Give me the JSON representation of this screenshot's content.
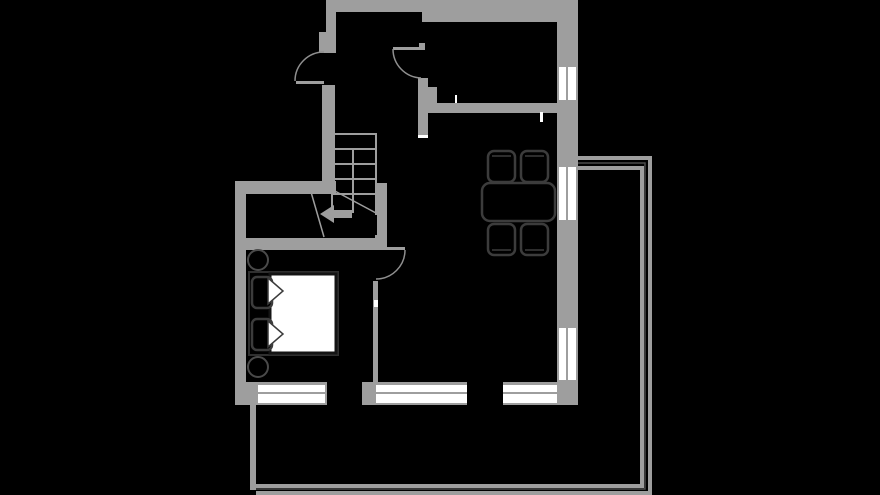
{
  "canvas": {
    "width": 880,
    "height": 495,
    "background": "#000000"
  },
  "palette": {
    "bg": "#000000",
    "wall": "#9e9e9e",
    "window": "#ffffff",
    "tick": "#ffffff",
    "arc": "#8f8f8f",
    "dark": "#4a4a4a",
    "furn": "#3c3c3c",
    "bedframe": "#2f2f2f",
    "mattress": "#ffffff",
    "mattressStroke": "#141414",
    "black": "#000000"
  },
  "floorplan": {
    "layers": [
      {
        "name": "walls",
        "items": [
          {
            "name": "wall-top-band-left",
            "kind": "rect",
            "x": 326,
            "y": 0,
            "w": 104,
            "h": 12,
            "fill": "wall"
          },
          {
            "name": "wall-top-band-right",
            "kind": "rect",
            "x": 422,
            "y": 0,
            "w": 156,
            "h": 22,
            "fill": "wall"
          },
          {
            "name": "wall-entry-upper",
            "kind": "rect",
            "x": 326,
            "y": 0,
            "w": 10,
            "h": 53,
            "fill": "wall"
          },
          {
            "name": "wall-entry-jog",
            "kind": "rect",
            "x": 319,
            "y": 32,
            "w": 8,
            "h": 21,
            "fill": "wall"
          },
          {
            "name": "wall-entry-lower",
            "kind": "rect",
            "x": 322,
            "y": 85,
            "w": 13,
            "h": 96,
            "fill": "wall"
          },
          {
            "name": "wall-hall-top",
            "kind": "rect",
            "x": 235,
            "y": 181,
            "w": 101,
            "h": 13,
            "fill": "wall"
          },
          {
            "name": "wall-left-outer",
            "kind": "rect",
            "x": 235,
            "y": 181,
            "w": 11,
            "h": 224,
            "fill": "wall"
          },
          {
            "name": "wall-bedroom-top",
            "kind": "rect",
            "x": 235,
            "y": 238,
            "w": 152,
            "h": 12,
            "fill": "wall"
          },
          {
            "name": "wall-stair-right",
            "kind": "rect",
            "x": 377,
            "y": 183,
            "w": 10,
            "h": 56,
            "fill": "wall"
          },
          {
            "name": "wall-bedroom-door-stub",
            "kind": "rect",
            "x": 375,
            "y": 235,
            "w": 10,
            "h": 13,
            "fill": "wall"
          },
          {
            "name": "wall-bedroom-right",
            "kind": "rect",
            "x": 373,
            "y": 281,
            "w": 5,
            "h": 101,
            "fill": "wall"
          },
          {
            "name": "wall-kitchen-stub-top",
            "kind": "rect",
            "x": 419,
            "y": 43,
            "w": 6,
            "h": 7,
            "fill": "wall"
          },
          {
            "name": "wall-kitchen-left",
            "kind": "rect",
            "x": 418,
            "y": 78,
            "w": 10,
            "h": 26,
            "fill": "wall"
          },
          {
            "name": "wall-kitchen-left-step",
            "kind": "rect",
            "x": 422,
            "y": 87,
            "w": 15,
            "h": 16,
            "fill": "wall"
          },
          {
            "name": "wall-kitchen-bottom",
            "kind": "rect",
            "x": 418,
            "y": 103,
            "w": 160,
            "h": 10,
            "fill": "wall"
          },
          {
            "name": "wall-kitchen-stub-bottom",
            "kind": "rect",
            "x": 418,
            "y": 113,
            "w": 10,
            "h": 25,
            "fill": "wall"
          },
          {
            "name": "wall-right-outer",
            "kind": "rect",
            "x": 557,
            "y": 22,
            "w": 21,
            "h": 383,
            "fill": "wall"
          },
          {
            "name": "wall-bottom-left-corner",
            "kind": "rect",
            "x": 235,
            "y": 382,
            "w": 23,
            "h": 23,
            "fill": "wall"
          },
          {
            "name": "wall-bottom-frame-1",
            "kind": "rect",
            "x": 258,
            "y": 382,
            "w": 67,
            "h": 23,
            "fill": "wall"
          },
          {
            "name": "wall-bottom-sliver",
            "kind": "rect",
            "x": 325,
            "y": 382,
            "w": 2,
            "h": 23,
            "fill": "wall"
          },
          {
            "name": "wall-bottom-mid",
            "kind": "rect",
            "x": 362,
            "y": 382,
            "w": 14,
            "h": 23,
            "fill": "wall"
          },
          {
            "name": "wall-bottom-frame-2",
            "kind": "rect",
            "x": 376,
            "y": 382,
            "w": 91,
            "h": 23,
            "fill": "wall"
          },
          {
            "name": "wall-bottom-frame-3",
            "kind": "rect",
            "x": 503,
            "y": 382,
            "w": 54,
            "h": 23,
            "fill": "wall"
          }
        ]
      },
      {
        "name": "windows",
        "items": [
          {
            "name": "window-right-top",
            "kind": "rect",
            "x": 559,
            "y": 67,
            "w": 17,
            "h": 33,
            "fill": "window"
          },
          {
            "name": "window-divider",
            "kind": "rect",
            "x": 566,
            "y": 67,
            "w": 2,
            "h": 33,
            "fill": "wall"
          },
          {
            "name": "window-right-middle",
            "kind": "rect",
            "x": 559,
            "y": 167,
            "w": 17,
            "h": 53,
            "fill": "window"
          },
          {
            "name": "window-divider",
            "kind": "rect",
            "x": 566,
            "y": 167,
            "w": 2,
            "h": 53,
            "fill": "wall"
          },
          {
            "name": "window-right-bottom",
            "kind": "rect",
            "x": 559,
            "y": 328,
            "w": 17,
            "h": 52,
            "fill": "window"
          },
          {
            "name": "window-divider",
            "kind": "rect",
            "x": 566,
            "y": 328,
            "w": 2,
            "h": 52,
            "fill": "wall"
          },
          {
            "name": "window-bottom-bedroom",
            "kind": "rect",
            "x": 258,
            "y": 385,
            "w": 67,
            "h": 18,
            "fill": "window"
          },
          {
            "name": "window-divider",
            "kind": "rect",
            "x": 258,
            "y": 392,
            "w": 67,
            "h": 2,
            "fill": "wall"
          },
          {
            "name": "window-bottom-living-1",
            "kind": "rect",
            "x": 376,
            "y": 385,
            "w": 91,
            "h": 18,
            "fill": "window"
          },
          {
            "name": "window-divider",
            "kind": "rect",
            "x": 376,
            "y": 392,
            "w": 91,
            "h": 2,
            "fill": "wall"
          },
          {
            "name": "window-bottom-living-2",
            "kind": "rect",
            "x": 503,
            "y": 385,
            "w": 54,
            "h": 18,
            "fill": "window"
          },
          {
            "name": "window-divider",
            "kind": "rect",
            "x": 503,
            "y": 392,
            "w": 54,
            "h": 2,
            "fill": "wall"
          }
        ]
      },
      {
        "name": "wall-ticks",
        "items": [
          {
            "name": "tick-kitchen-wall",
            "kind": "rect",
            "x": 455,
            "y": 95,
            "w": 2,
            "h": 8,
            "fill": "tick"
          },
          {
            "name": "tick-living-wall",
            "kind": "rect",
            "x": 540,
            "y": 112,
            "w": 3,
            "h": 10,
            "fill": "tick"
          },
          {
            "name": "tick-wall-end",
            "kind": "rect",
            "x": 418,
            "y": 135,
            "w": 10,
            "h": 3,
            "fill": "tick"
          },
          {
            "name": "tick-bedroom-wall",
            "kind": "rect",
            "x": 374,
            "y": 300,
            "w": 4,
            "h": 7,
            "fill": "tick"
          }
        ]
      },
      {
        "name": "doors",
        "items": [
          {
            "name": "entry-door-leaf",
            "kind": "rect",
            "x": 296,
            "y": 81,
            "w": 28,
            "h": 3,
            "fill": "wall"
          },
          {
            "name": "entry-door-arc",
            "kind": "path",
            "d": "M 324 52 A 29 29 0 0 0 295 81",
            "stroke": "arc",
            "sw": 1.5
          },
          {
            "name": "kitchen-door-leaf",
            "kind": "rect",
            "x": 393,
            "y": 47,
            "w": 30,
            "h": 3,
            "fill": "wall"
          },
          {
            "name": "kitchen-door-arc",
            "kind": "path",
            "d": "M 393 49 A 29 29 0 0 0 421 78",
            "stroke": "arc",
            "sw": 1.5
          },
          {
            "name": "bedroom-door-leaf",
            "kind": "rect",
            "x": 378,
            "y": 247,
            "w": 27,
            "h": 3,
            "fill": "wall"
          },
          {
            "name": "bedroom-door-arc",
            "kind": "path",
            "d": "M 405 250 A 29 29 0 0 1 376 279",
            "stroke": "arc",
            "sw": 1.5
          }
        ]
      },
      {
        "name": "stairs",
        "items": [
          {
            "name": "stair-top-edge",
            "kind": "line",
            "x1": 331,
            "y1": 134,
            "x2": 377,
            "y2": 134,
            "stroke": "wall",
            "sw": 2
          },
          {
            "name": "stair-left-edge",
            "kind": "line",
            "x1": 332,
            "y1": 134,
            "x2": 332,
            "y2": 212,
            "stroke": "wall",
            "sw": 2
          },
          {
            "name": "stair-right-edge",
            "kind": "line",
            "x1": 376,
            "y1": 134,
            "x2": 376,
            "y2": 215,
            "stroke": "wall",
            "sw": 2
          },
          {
            "name": "stair-tread",
            "kind": "line",
            "x1": 331,
            "y1": 149,
            "x2": 376,
            "y2": 149,
            "stroke": "wall",
            "sw": 2
          },
          {
            "name": "stair-tread",
            "kind": "line",
            "x1": 331,
            "y1": 164,
            "x2": 376,
            "y2": 164,
            "stroke": "wall",
            "sw": 2
          },
          {
            "name": "stair-tread",
            "kind": "line",
            "x1": 331,
            "y1": 179,
            "x2": 376,
            "y2": 179,
            "stroke": "wall",
            "sw": 2
          },
          {
            "name": "stair-tread",
            "kind": "line",
            "x1": 331,
            "y1": 194,
            "x2": 376,
            "y2": 194,
            "stroke": "wall",
            "sw": 2
          },
          {
            "name": "stair-mid-rail",
            "kind": "line",
            "x1": 353,
            "y1": 149,
            "x2": 353,
            "y2": 213,
            "stroke": "wall",
            "sw": 2
          },
          {
            "name": "stair-break-line",
            "kind": "line",
            "x1": 333,
            "y1": 190,
            "x2": 376,
            "y2": 213,
            "stroke": "wall",
            "sw": 1.5
          },
          {
            "name": "stair-break-line",
            "kind": "line",
            "x1": 311,
            "y1": 192,
            "x2": 324,
            "y2": 237,
            "stroke": "wall",
            "sw": 1.5
          },
          {
            "name": "stair-arrow-shaft",
            "kind": "rect",
            "x": 331,
            "y": 210,
            "w": 21,
            "h": 8,
            "fill": "wall"
          },
          {
            "name": "stair-arrow-head",
            "kind": "polygon",
            "points": "320,214 334,205 334,223",
            "fill": "wall"
          }
        ]
      },
      {
        "name": "terrace",
        "items": [
          {
            "name": "terrace-left-edge",
            "kind": "rect",
            "x": 250,
            "y": 405,
            "w": 6,
            "h": 85,
            "fill": "wall"
          },
          {
            "name": "terrace-outer-rail",
            "kind": "path",
            "d": "M 578 158 H 650 V 493 H 256",
            "stroke": "wall",
            "sw": 4
          },
          {
            "name": "terrace-dark-rail",
            "kind": "path",
            "d": "M 578 163 H 645 V 489 H 256",
            "stroke": "dark",
            "sw": 1.5
          },
          {
            "name": "terrace-inner-rail",
            "kind": "path",
            "d": "M 578 168 H 642 V 486 H 256",
            "stroke": "wall",
            "sw": 4
          }
        ]
      },
      {
        "name": "furniture",
        "items": [
          {
            "name": "dining-table",
            "kind": "rect",
            "x": 482,
            "y": 183,
            "w": 73,
            "h": 38,
            "rx": 8,
            "fill": "black",
            "stroke": "furn",
            "sw": 2.5
          },
          {
            "name": "dining-chair",
            "kind": "rect",
            "x": 488,
            "y": 151,
            "w": 27,
            "h": 31,
            "rx": 6,
            "fill": "black",
            "stroke": "furn",
            "sw": 2.5
          },
          {
            "name": "dining-chair",
            "kind": "rect",
            "x": 521,
            "y": 151,
            "w": 27,
            "h": 31,
            "rx": 6,
            "fill": "black",
            "stroke": "furn",
            "sw": 2.5
          },
          {
            "name": "dining-chair",
            "kind": "rect",
            "x": 488,
            "y": 224,
            "w": 27,
            "h": 31,
            "rx": 6,
            "fill": "black",
            "stroke": "furn",
            "sw": 2.5
          },
          {
            "name": "dining-chair",
            "kind": "rect",
            "x": 521,
            "y": 224,
            "w": 27,
            "h": 31,
            "rx": 6,
            "fill": "black",
            "stroke": "furn",
            "sw": 2.5
          },
          {
            "name": "chair-back-line",
            "kind": "line",
            "x1": 492,
            "y1": 156,
            "x2": 511,
            "y2": 156,
            "stroke": "furn",
            "sw": 1.5
          },
          {
            "name": "chair-back-line",
            "kind": "line",
            "x1": 525,
            "y1": 156,
            "x2": 544,
            "y2": 156,
            "stroke": "furn",
            "sw": 1.5
          },
          {
            "name": "chair-back-line",
            "kind": "line",
            "x1": 492,
            "y1": 250,
            "x2": 511,
            "y2": 250,
            "stroke": "furn",
            "sw": 1.5
          },
          {
            "name": "chair-back-line",
            "kind": "line",
            "x1": 525,
            "y1": 250,
            "x2": 544,
            "y2": 250,
            "stroke": "furn",
            "sw": 1.5
          },
          {
            "name": "bed-frame",
            "kind": "rect",
            "x": 249,
            "y": 272,
            "w": 89,
            "h": 83,
            "fill": "black",
            "stroke": "bedframe",
            "sw": 2
          },
          {
            "name": "bed-mattress",
            "kind": "rect",
            "x": 270,
            "y": 274,
            "w": 66,
            "h": 79,
            "fill": "mattress",
            "stroke": "mattressStroke",
            "sw": 3
          },
          {
            "name": "bed-pillow",
            "kind": "rect",
            "x": 252,
            "y": 277,
            "w": 20,
            "h": 31,
            "rx": 5,
            "fill": "black",
            "stroke": "furn",
            "sw": 2.5
          },
          {
            "name": "bed-pillow",
            "kind": "rect",
            "x": 252,
            "y": 319,
            "w": 20,
            "h": 31,
            "rx": 5,
            "fill": "black",
            "stroke": "furn",
            "sw": 2.5
          },
          {
            "name": "duvet-fold",
            "kind": "polygon",
            "points": "268,278 283,291 268,304",
            "fill": "mattress",
            "stroke": "furn",
            "sw": 1.5
          },
          {
            "name": "duvet-fold",
            "kind": "polygon",
            "points": "268,321 283,334 268,347",
            "fill": "mattress",
            "stroke": "furn",
            "sw": 1.5
          },
          {
            "name": "nightstand",
            "kind": "circle",
            "cx": 258,
            "cy": 260,
            "r": 10,
            "fill": "black",
            "stroke": "dark",
            "sw": 2
          },
          {
            "name": "nightstand",
            "kind": "circle",
            "cx": 258,
            "cy": 367,
            "r": 10,
            "fill": "black",
            "stroke": "dark",
            "sw": 2
          }
        ]
      }
    ]
  }
}
